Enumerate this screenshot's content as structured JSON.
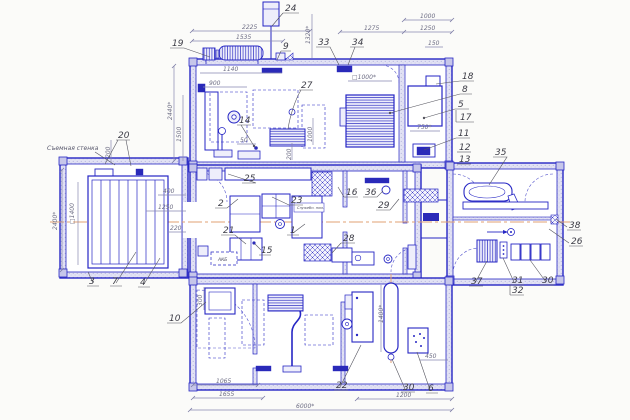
{
  "meta": {
    "drawing_type": "container-module facility floor plan (CAD blueprint)",
    "language": "ru"
  },
  "colors": {
    "line": "#2626c4",
    "dark_fill": "#2a2ab8",
    "wall_fill": "#e2e2f4",
    "centerline": "#e2a273",
    "dim_line": "#8888b0",
    "callout_text": "#3d3d47",
    "dim_text": "#6e6e85",
    "background": "#fbfbf9"
  },
  "labels": {
    "removable_wall": "Съемная стенка",
    "service_room": "Служебн. пом.",
    "battery": "АКБ"
  },
  "callouts": [
    {
      "n": "24"
    },
    {
      "n": "19"
    },
    {
      "n": "9"
    },
    {
      "n": "33"
    },
    {
      "n": "34"
    },
    {
      "n": "18"
    },
    {
      "n": "8"
    },
    {
      "n": "5"
    },
    {
      "n": "17"
    },
    {
      "n": "11"
    },
    {
      "n": "12"
    },
    {
      "n": "13"
    },
    {
      "n": "35"
    },
    {
      "n": "20"
    },
    {
      "n": "27"
    },
    {
      "n": "14"
    },
    {
      "n": "25"
    },
    {
      "n": "2"
    },
    {
      "n": "23"
    },
    {
      "n": "21"
    },
    {
      "n": "1"
    },
    {
      "n": "15"
    },
    {
      "n": "16"
    },
    {
      "n": "36"
    },
    {
      "n": "29"
    },
    {
      "n": "28"
    },
    {
      "n": "3"
    },
    {
      "n": "7"
    },
    {
      "n": "4"
    },
    {
      "n": "10"
    },
    {
      "n": "22"
    },
    {
      "n": "30"
    },
    {
      "n": "6"
    },
    {
      "n": "37"
    },
    {
      "n": "31"
    },
    {
      "n": "32"
    },
    {
      "n": "30"
    },
    {
      "n": "38"
    },
    {
      "n": "26"
    }
  ],
  "dimensions": [
    {
      "v": "2225"
    },
    {
      "v": "1535"
    },
    {
      "v": "1320*"
    },
    {
      "v": "1000"
    },
    {
      "v": "1275"
    },
    {
      "v": "1250"
    },
    {
      "v": "150"
    },
    {
      "v": "2440*"
    },
    {
      "v": "1500"
    },
    {
      "v": "1140"
    },
    {
      "v": "900"
    },
    {
      "v": "□1000*"
    },
    {
      "v": "750*"
    },
    {
      "v": "50"
    },
    {
      "v": "200"
    },
    {
      "v": "1000"
    },
    {
      "v": "200"
    },
    {
      "v": "2400*"
    },
    {
      "v": "□1400"
    },
    {
      "v": "400"
    },
    {
      "v": "1250"
    },
    {
      "v": "220"
    },
    {
      "v": "300"
    },
    {
      "v": "1065"
    },
    {
      "v": "1655"
    },
    {
      "v": "6000*"
    },
    {
      "v": "1200"
    },
    {
      "v": "450"
    },
    {
      "v": "1400*"
    }
  ]
}
